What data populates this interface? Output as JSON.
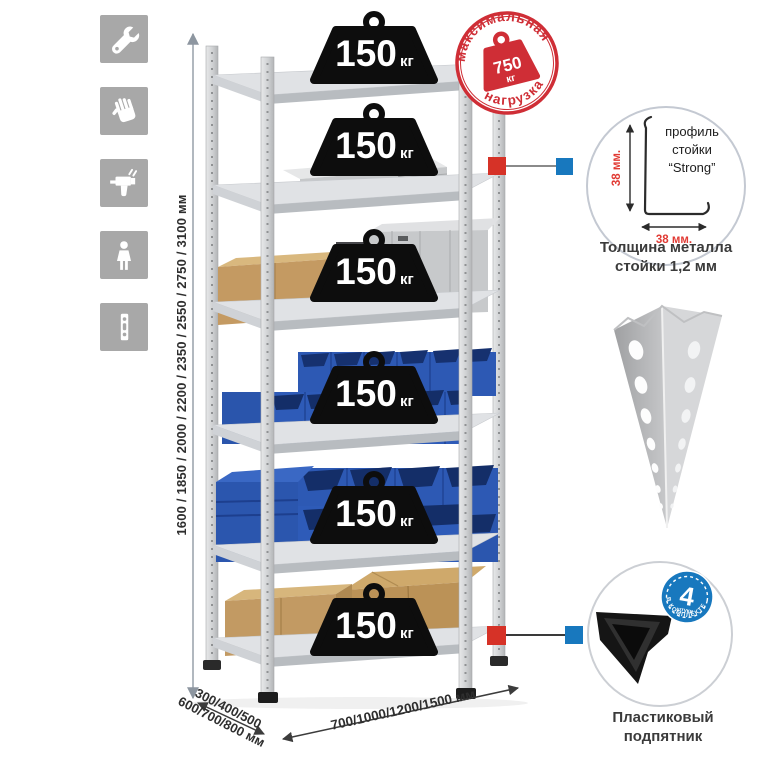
{
  "dimensions": {
    "height_options": "1600 / 1850 / 2000 / 2200 / 2350 / 2550 / 2750 / 3100 мм",
    "depth_options_line1": "300/400/500",
    "depth_options_line2": "600/700/800 мм",
    "width_options": "700/1000/1200/1500 мм"
  },
  "rack": {
    "shelf_count": 6,
    "load_unit": "кг",
    "shelves": [
      {
        "load": "150"
      },
      {
        "load": "150"
      },
      {
        "load": "150"
      },
      {
        "load": "150"
      },
      {
        "load": "150"
      },
      {
        "load": "150"
      }
    ]
  },
  "stamp": {
    "arc_top": "максимальная",
    "arc_bottom": "нагрузка",
    "value": "750",
    "unit": "кг"
  },
  "profile_callout": {
    "line1": "профиль",
    "line2": "стойки",
    "line3": "“Strong”",
    "dim_vertical": "38 мм.",
    "dim_horizontal": "38 мм.",
    "caption_line1": "Толщина металла",
    "caption_line2": "стойки 1,2 мм"
  },
  "foot_callout": {
    "badge_value": "4",
    "badge_sub": "штуки",
    "badge_arc": "в комплекте",
    "caption_line1": "Пластиковый",
    "caption_line2": "подпятник"
  },
  "sidebar_icons": [
    "wrench-icon",
    "gloves-icon",
    "drill-icon",
    "person-icon",
    "perforated-post-icon"
  ],
  "colors": {
    "stamp_red": "#cf2e36",
    "callout_red": "#d63227",
    "callout_blue": "#1878be",
    "badge_blue": "#1878be",
    "bin_blue": "#2e5bb8",
    "metal_gray": "#dcdee1",
    "cardboard": "#c29a63",
    "tile_gray": "#a8a8a8"
  }
}
